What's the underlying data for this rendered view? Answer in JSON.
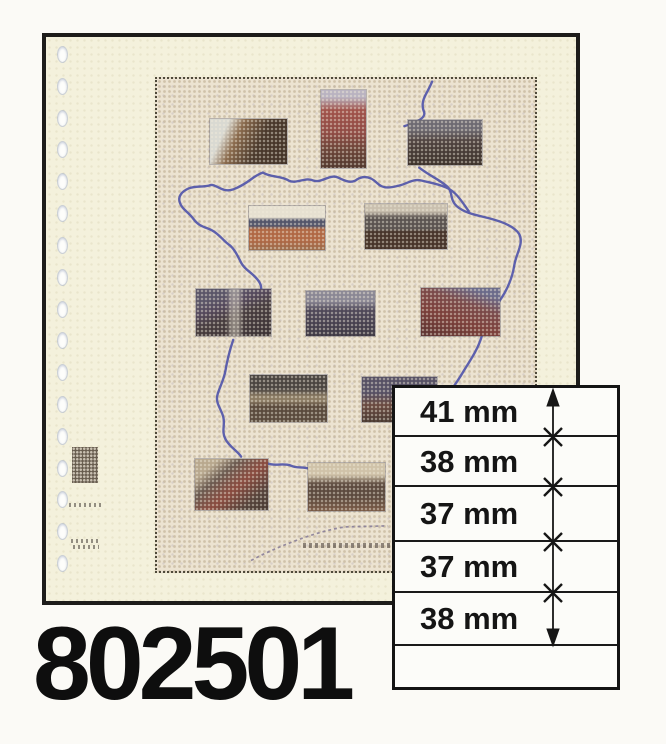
{
  "product": {
    "number": "802501"
  },
  "spec_table": {
    "unit": "mm",
    "rows": [
      {
        "label": "41 mm",
        "value_mm": 41
      },
      {
        "label": "38 mm",
        "value_mm": 38
      },
      {
        "label": "37 mm",
        "value_mm": 37
      },
      {
        "label": "37 mm",
        "value_mm": 37
      },
      {
        "label": "38 mm",
        "value_mm": 38
      }
    ]
  },
  "page_preview": {
    "stamp_slots": 12,
    "binder_holes": 17
  },
  "colors": {
    "frame_border": "#1d1c1a",
    "page_cream": "#f4f1dc",
    "print_beige": "#ece3d1",
    "map_outline_blue": "#4a4fa8",
    "table_background": "#fcfcf9",
    "ink_black": "#141414"
  }
}
